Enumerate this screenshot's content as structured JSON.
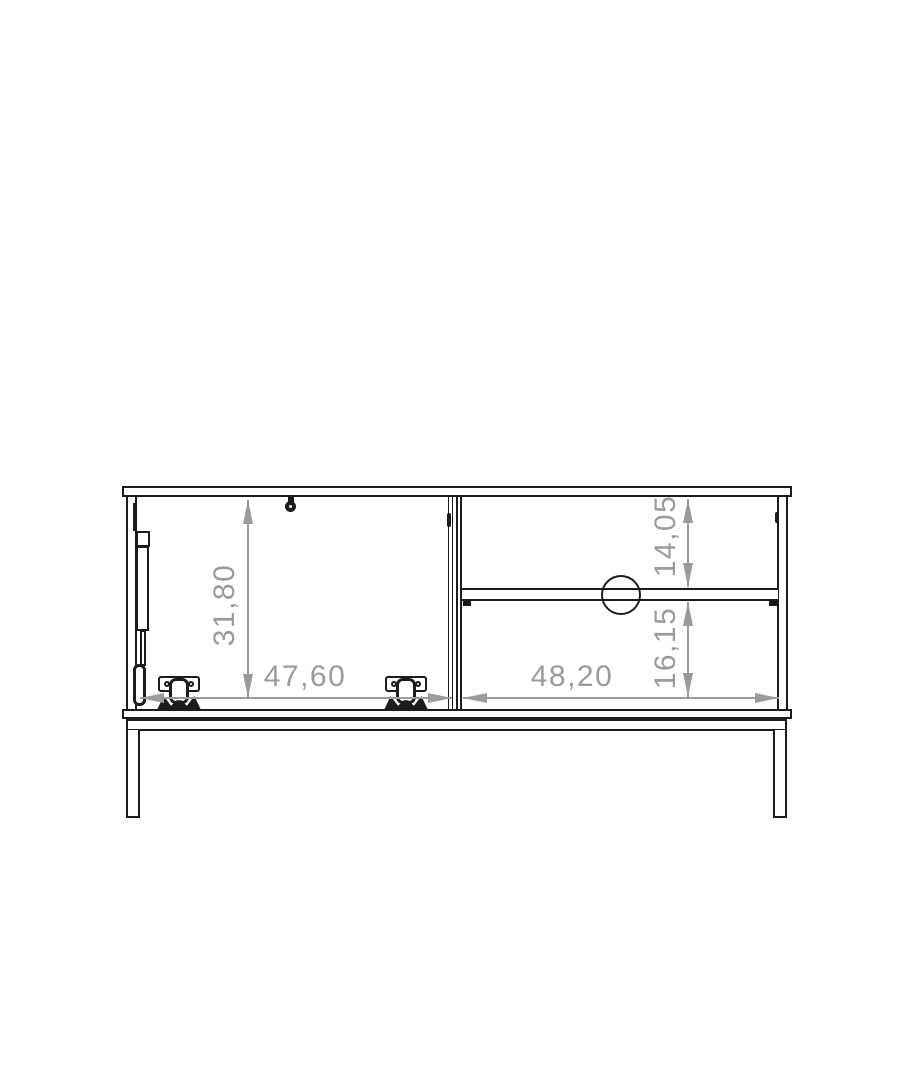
{
  "drawing": {
    "dimensions": {
      "left_section_height": "31,80",
      "left_section_width": "47,60",
      "right_section_width": "48,20",
      "right_top_height": "14,05",
      "right_bottom_height": "16,15"
    },
    "colors": {
      "structure_line": "#1c1c1c",
      "dimension_line": "#9b9b9b",
      "background": "#ffffff"
    }
  }
}
